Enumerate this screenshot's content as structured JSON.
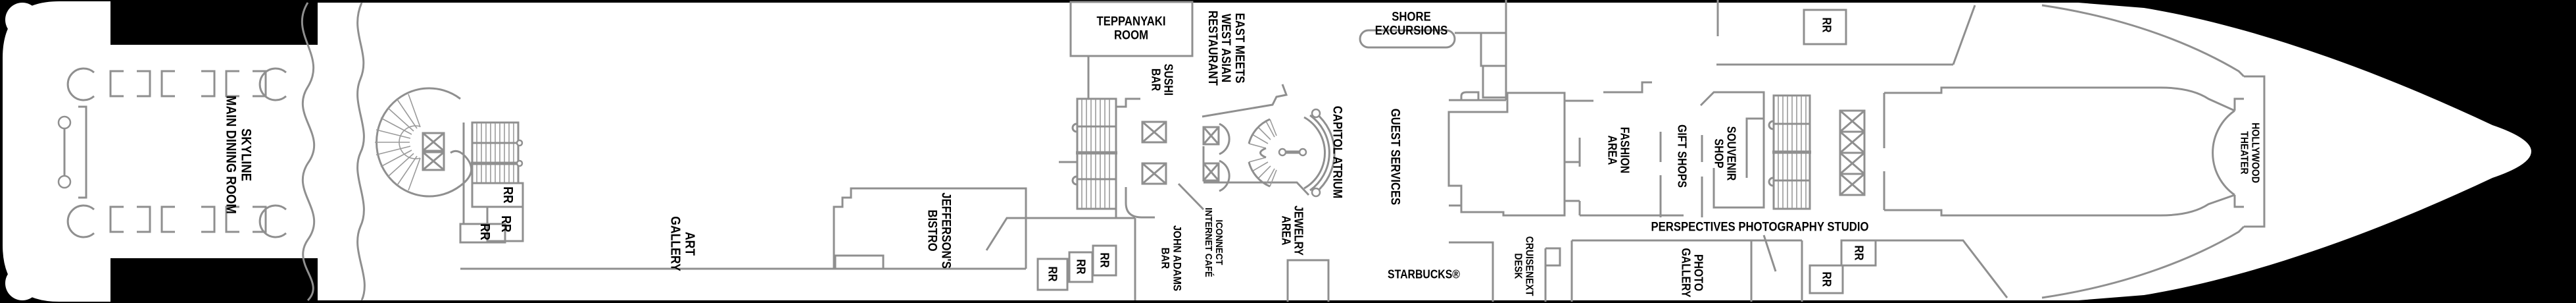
{
  "meta": {
    "background_color": "#000000",
    "hull_color": "#ffffff",
    "wall_line_color": "#8f8f8f",
    "label_color": "#000000",
    "plan_type": "cruise ship deck plan"
  },
  "labels": {
    "skyline_main_dining_room": [
      "SKYLINE",
      "MAIN DINING ROOM"
    ],
    "art_gallery": [
      "ART",
      "GALLERY"
    ],
    "jeffersons_bistro": [
      "JEFFERSON'S",
      "BISTRO"
    ],
    "teppanyaki_room": [
      "TEPPANYAKI",
      "ROOM"
    ],
    "sushi_bar": [
      "SUSHI",
      "BAR"
    ],
    "east_meets_west": [
      "EAST MEETS",
      "WEST ASIAN",
      "RESTAURANT"
    ],
    "john_adams_bar": [
      "JOHN ADAMS",
      "BAR"
    ],
    "iconnect_internet_cafe": [
      "ICONNECT",
      "INTERNET CAFÉ"
    ],
    "jewelry_area": [
      "JEWELRY",
      "AREA"
    ],
    "capitol_atrium": [
      "CAPITOL ATRIUM"
    ],
    "shore_excursions": [
      "SHORE",
      "EXCURSIONS"
    ],
    "guest_services": [
      "GUEST SERVICES"
    ],
    "starbucks": [
      "STARBUCKS®"
    ],
    "cruisenext_desk": [
      "CRUISENEXT",
      "DESK"
    ],
    "fashion_area": [
      "FASHION",
      "AREA"
    ],
    "gift_shops": [
      "GIFT SHOPS"
    ],
    "souvenir_shop": [
      "SOUVENIR",
      "SHOP"
    ],
    "perspectives_photography_studio": [
      "PERSPECTIVES PHOTOGRAPHY STUDIO"
    ],
    "photo_gallery": [
      "PHOTO",
      "GALLERY"
    ],
    "hollywood_theater": [
      "HOLLYWOOD",
      "THEATER"
    ],
    "restroom": "RR"
  }
}
